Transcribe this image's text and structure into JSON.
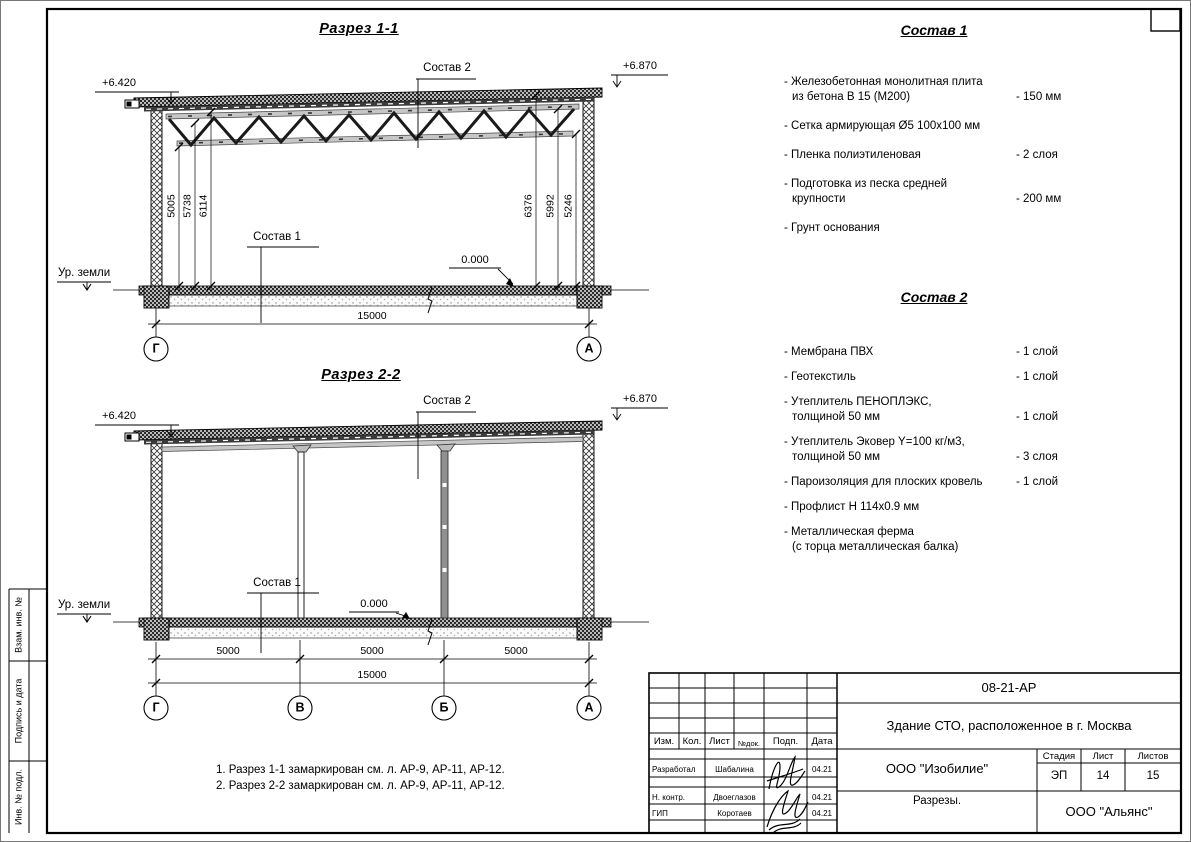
{
  "sheet": {
    "side_labels": [
      "Взам. инв. №",
      "Подпись и дата",
      "Инв. № подл."
    ]
  },
  "section1": {
    "title": "Разрез 1-1",
    "composition2_label": "Состав 2",
    "composition1_label": "Состав 1",
    "elevation_left": "+6.420",
    "elevation_right": "+6.870",
    "zero_level": "0.000",
    "ground_label": "Ур. земли",
    "dims_left": [
      "5005",
      "5738",
      "6114"
    ],
    "dims_right": [
      "6376",
      "5992",
      "5246"
    ],
    "total_dim": "15000",
    "axis_left": "Г",
    "axis_right": "А"
  },
  "section2": {
    "title": "Разрез 2-2",
    "composition2_label": "Состав 2",
    "composition1_label": "Состав 1",
    "elevation_left": "+6.420",
    "elevation_right": "+6.870",
    "zero_level": "0.000",
    "ground_label": "Ур. земли",
    "span_dims": [
      "5000",
      "5000",
      "5000"
    ],
    "total_dim": "15000",
    "axes": [
      "Г",
      "В",
      "Б",
      "А"
    ]
  },
  "composition1": {
    "title": "Состав 1",
    "items": [
      {
        "lines": [
          "- Железобетонная  монолитная плита",
          "из бетона В 15 (М200)"
        ],
        "value": "- 150 мм"
      },
      {
        "lines": [
          "- Сетка армирующая Ø5 100х100 мм",
          ""
        ],
        "value": ""
      },
      {
        "lines": [
          "- Пленка полиэтиленовая",
          ""
        ],
        "value": "-  2 слоя"
      },
      {
        "lines": [
          "- Подготовка из песка средней",
          "крупности"
        ],
        "value": "- 200 мм"
      },
      {
        "lines": [
          "- Грунт основания",
          ""
        ],
        "value": ""
      }
    ]
  },
  "composition2": {
    "title": "Состав 2",
    "items": [
      {
        "lines": [
          "- Мембрана ПВХ",
          ""
        ],
        "value": "- 1 слой"
      },
      {
        "lines": [
          "- Геотекстиль",
          ""
        ],
        "value": "- 1 слой"
      },
      {
        "lines": [
          "- Утеплитель ПЕНОПЛЭКС,",
          "толщиной 50 мм"
        ],
        "value": "- 1 слой"
      },
      {
        "lines": [
          "- Утеплитель Эковер Y=100 кг/м3,",
          "толщиной 50 мм"
        ],
        "value": "- 3 слоя"
      },
      {
        "lines": [
          "- Пароизоляция для плоских кровель",
          ""
        ],
        "value": "- 1 слой"
      },
      {
        "lines": [
          "- Профлист Н 114х0.9 мм",
          ""
        ],
        "value": ""
      },
      {
        "lines": [
          "- Металлическая ферма",
          "(с торца металлическая балка)"
        ],
        "value": ""
      }
    ]
  },
  "notes": [
    "1. Разрез 1-1 замаркирован см. л. АР-9, АР-11, АР-12.",
    "2. Разрез 2-2 замаркирован см. л. АР-9, АР-11, АР-12."
  ],
  "titleblock": {
    "doc_number": "08-21-АР",
    "project_name": "Здание СТО, расположенное в г. Москва",
    "designer_org": "ООО \"Изобилие\"",
    "sheet_name": "Разрезы.",
    "contractor_org": "ООО \"Альянс\"",
    "stage_label": "Стадия",
    "stage_value": "ЭП",
    "sheet_label": "Лист",
    "sheet_value": "14",
    "sheets_label": "Листов",
    "sheets_value": "15",
    "columns": [
      "Изм.",
      "Кол.",
      "Лист",
      "№док.",
      "Подп.",
      "Дата"
    ],
    "rows": [
      {
        "role": "Разработал",
        "name": "Шабалина",
        "date": "04.21"
      },
      {
        "role": "Н. контр.",
        "name": "Двоеглазов",
        "date": "04.21"
      },
      {
        "role": "ГИП",
        "name": "Коротаев",
        "date": "04.21"
      }
    ]
  }
}
